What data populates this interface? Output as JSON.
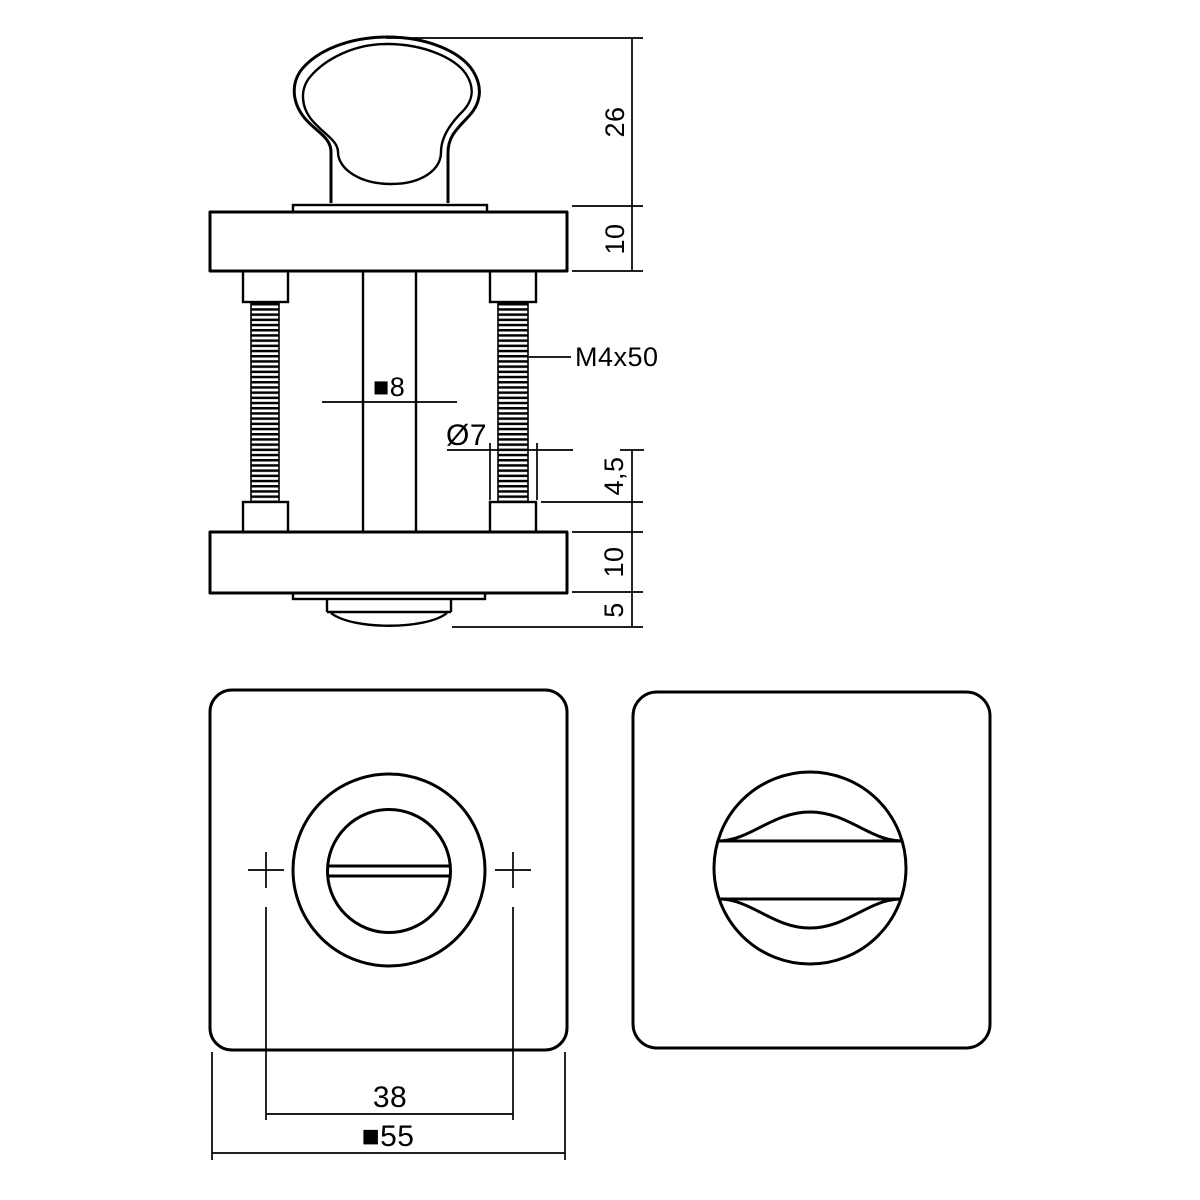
{
  "colors": {
    "line": "#000000",
    "background": "#ffffff"
  },
  "side_view": {
    "dim_knob_height": "26",
    "dim_top_rose_thickness": "10",
    "bolt_label": "M4x50",
    "spindle_label": "■8",
    "pin_diameter_label": "Ø7",
    "dim_pin_protrusion": "4,5",
    "dim_bottom_rose_thickness": "10",
    "dim_release_button_height": "5"
  },
  "front_view": {
    "dim_screw_hole_spacing": "38",
    "dim_rose_size": "■55"
  }
}
